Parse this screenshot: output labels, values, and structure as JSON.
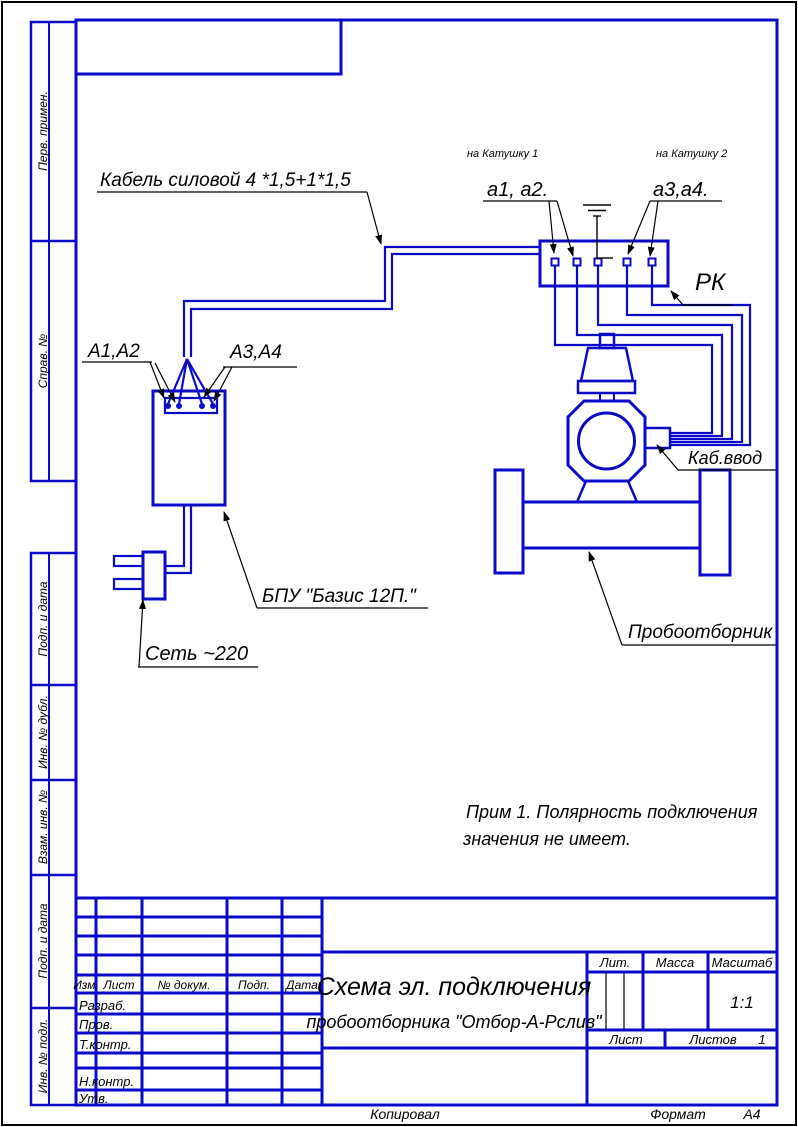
{
  "sheet": {
    "format_label": "Формат",
    "format_value": "А4",
    "kopiroval": "Копировал"
  },
  "margin_stamps": {
    "top": [
      "Перв. примен.",
      "Справ. №"
    ],
    "bottom": [
      "Подп. и дата",
      "Инв. № дубл.",
      "Взам. инв. №",
      "Подп. и дата",
      "Инв. № подл."
    ]
  },
  "schematic": {
    "labels": {
      "power_cable": "Кабель силовой 4 *1,5+1*1,5",
      "to_coil_1": "на Катушку 1",
      "to_coil_2": "на Катушку 2",
      "a1a2_terminals": "а1, а2.",
      "a3a4_terminals": "а3,а4.",
      "junction_box": "РК",
      "a1a2_block": "А1,А2",
      "a3a4_block": "А3,А4",
      "control_unit": "БПУ \"Базис 12П.\"",
      "mains": "Сеть ~220",
      "cable_entry": "Каб.ввод",
      "sampler": "Пробоотборник"
    },
    "note_line1": "Прим 1. Полярность подключения",
    "note_line2": "значения не имеет."
  },
  "title_block": {
    "header_cols": [
      "Изм.",
      "Лист",
      "№ докум.",
      "Подп.",
      "Дата"
    ],
    "staff_rows": [
      "Разраб.",
      "Пров.",
      "Т.контр.",
      "Н.контр.",
      "Утв."
    ],
    "title_line1": "Схема эл. подключения",
    "title_line2": "пробоотборника \"Отбор-А-Рслив\"",
    "lit": "Лит.",
    "mass": "Масса",
    "scale": "Масштаб",
    "scale_value": "1:1",
    "sheet": "Лист",
    "sheets": "Листов",
    "sheets_value": "1"
  },
  "colors": {
    "line_blue": "#0a0ac8",
    "ink_black": "#000000"
  }
}
